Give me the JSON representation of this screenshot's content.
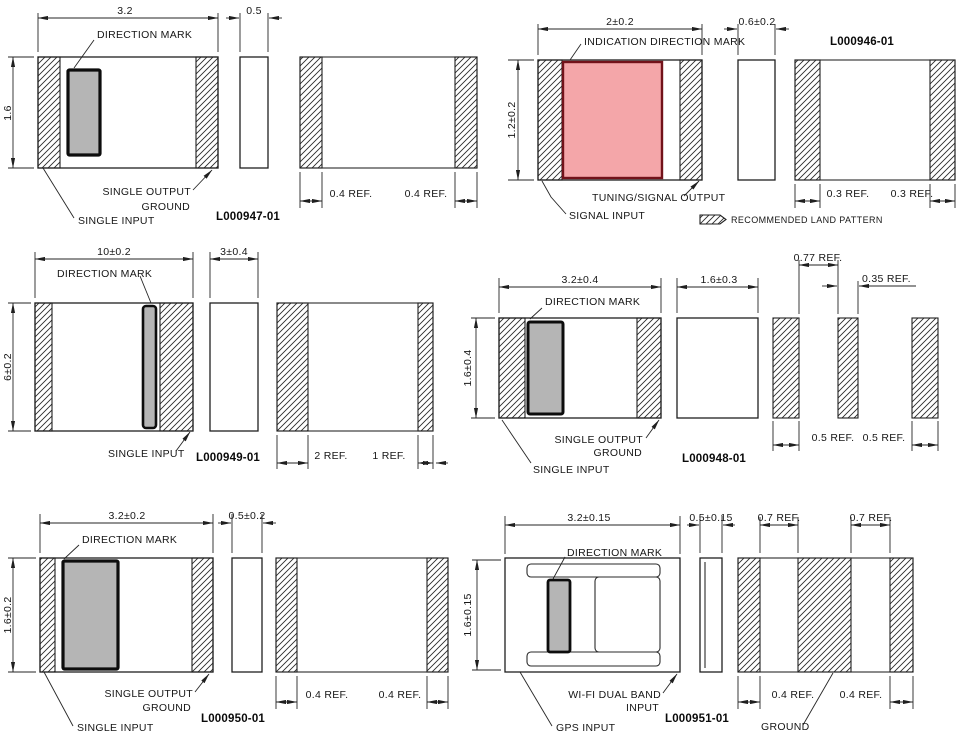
{
  "drawing": {
    "type": "package-dimension-drawing",
    "legend": {
      "label": "RECOMMENDED LAND PATTERN"
    },
    "colors": {
      "line": "#1f1f1f",
      "direction_mark_fill": "#b5b5b5",
      "indication_mark_fill": "#f4a6a9",
      "indication_mark_border": "#72121a"
    },
    "panels": [
      {
        "part_number": "L000947-01",
        "labels": {
          "direction_mark": "DIRECTION MARK",
          "output_line1": "SINGLE OUTPUT",
          "output_line2": "GROUND",
          "input": "SINGLE INPUT"
        },
        "dims": {
          "width": "3.2",
          "height": "1.6",
          "thickness": "0.5",
          "pad_left": "0.4 REF.",
          "pad_right": "0.4 REF."
        }
      },
      {
        "part_number": "L000946-01",
        "labels": {
          "direction_mark": "INDICATION DIRECTION MARK",
          "output": "TUNING/SIGNAL OUTPUT",
          "input": "SIGNAL INPUT"
        },
        "dims": {
          "width": "2±0.2",
          "height": "1.2±0.2",
          "thickness": "0.6±0.2",
          "pad_left": "0.3 REF.",
          "pad_right": "0.3 REF."
        }
      },
      {
        "part_number": "L000949-01",
        "labels": {
          "direction_mark": "DIRECTION MARK",
          "input": "SINGLE INPUT"
        },
        "dims": {
          "width": "10±0.2",
          "height": "6±0.2",
          "thickness": "3±0.4",
          "pad_left": "2 REF.",
          "pad_right": "1 REF."
        }
      },
      {
        "part_number": "L000948-01",
        "labels": {
          "direction_mark": "DIRECTION MARK",
          "output_line1": "SINGLE OUTPUT",
          "output_line2": "GROUND",
          "input": "SINGLE INPUT"
        },
        "dims": {
          "width": "3.2±0.4",
          "height": "1.6±0.4",
          "thickness": "1.6±0.3",
          "pad_gap": "0.77 REF.",
          "center_pad": "0.35 REF.",
          "pad_left": "0.5 REF.",
          "pad_right": "0.5 REF."
        }
      },
      {
        "part_number": "L000950-01",
        "labels": {
          "direction_mark": "DIRECTION MARK",
          "output_line1": "SINGLE OUTPUT",
          "output_line2": "GROUND",
          "input": "SINGLE INPUT"
        },
        "dims": {
          "width": "3.2±0.2",
          "height": "1.6±0.2",
          "thickness": "0.5±0.2",
          "pad_left": "0.4 REF.",
          "pad_right": "0.4 REF."
        }
      },
      {
        "part_number": "L000951-01",
        "labels": {
          "direction_mark": "DIRECTION MARK",
          "output_line1": "WI-FI DUAL BAND",
          "output_line2": "INPUT",
          "input": "GPS INPUT",
          "ground": "GROUND"
        },
        "dims": {
          "width": "3.2±0.15",
          "height": "1.6±0.15",
          "thickness": "0.5±0.15",
          "gap_left": "0.7 REF.",
          "gap_right": "0.7 REF.",
          "pad_left": "0.4 REF.",
          "pad_right": "0.4 REF."
        }
      }
    ]
  }
}
